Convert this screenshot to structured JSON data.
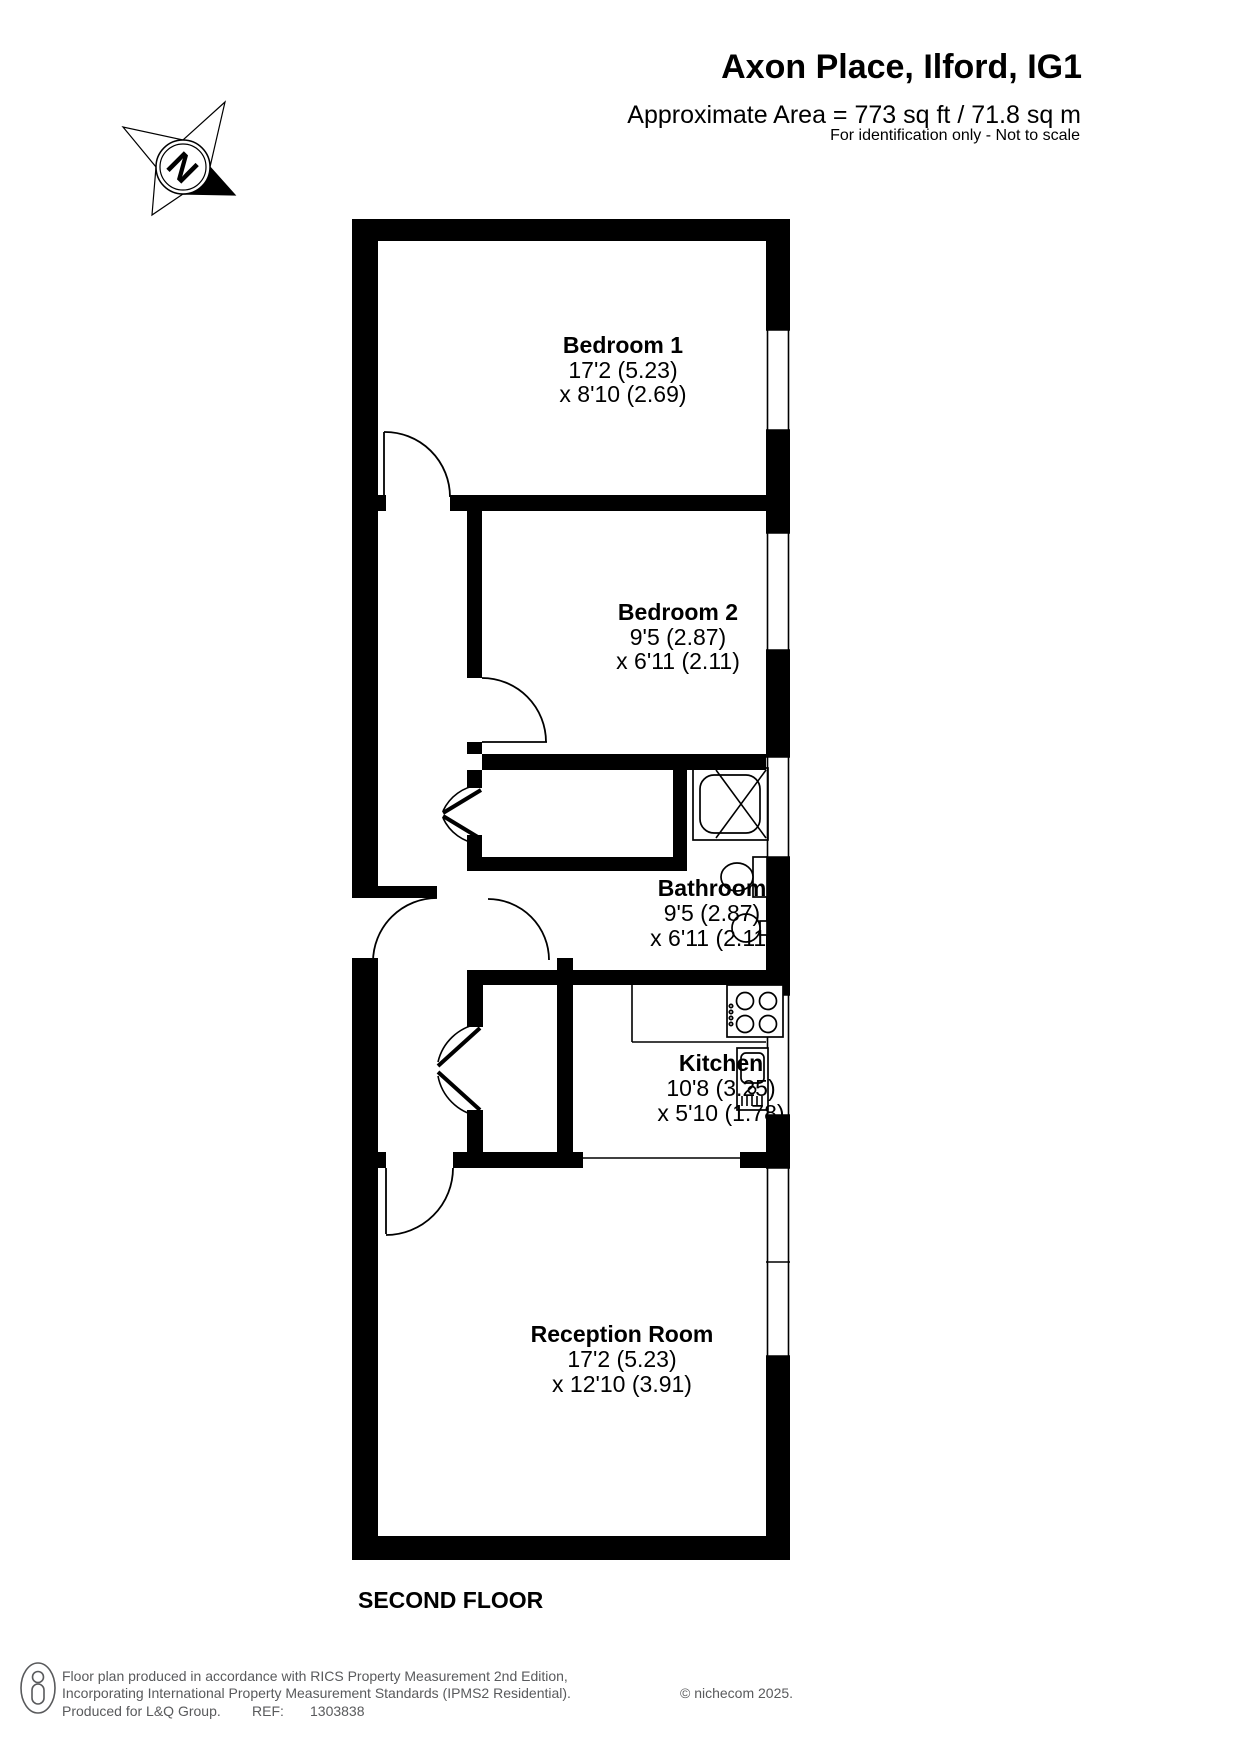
{
  "header": {
    "title": "Axon Place, Ilford, IG1",
    "subtitle": "Approximate Area = 773 sq ft / 71.8 sq m",
    "disclaimer": "For identification only - Not to scale"
  },
  "compass": {
    "north_label": "N"
  },
  "plan": {
    "floor_label": "SECOND FLOOR"
  },
  "rooms": [
    {
      "name": "Bedroom 1",
      "dim1": "17'2 (5.23)",
      "dim2": "x 8'10 (2.69)"
    },
    {
      "name": "Bedroom 2",
      "dim1": "9'5 (2.87)",
      "dim2": "x 6'11 (2.11)"
    },
    {
      "name": "Bathroom",
      "dim1": "9'5 (2.87)",
      "dim2": "x 6'11 (2.11)"
    },
    {
      "name": "Kitchen",
      "dim1": "10'8 (3.25)",
      "dim2": "x 5'10 (1.78)"
    },
    {
      "name": "Reception Room",
      "dim1": "17'2 (5.23)",
      "dim2": "x 12'10 (3.91)"
    }
  ],
  "footer": {
    "line1": "Floor plan produced in accordance with RICS Property Measurement 2nd Edition,",
    "line2": "Incorporating International Property Measurement Standards (IPMS2 Residential).",
    "copyright": "© nichecom 2025.",
    "produced": "Produced for L&Q Group.",
    "ref_label": "REF:",
    "ref_number": "1303838"
  },
  "colors": {
    "wall": "#000000",
    "text": "#000000",
    "footer_text": "#595a5c"
  }
}
